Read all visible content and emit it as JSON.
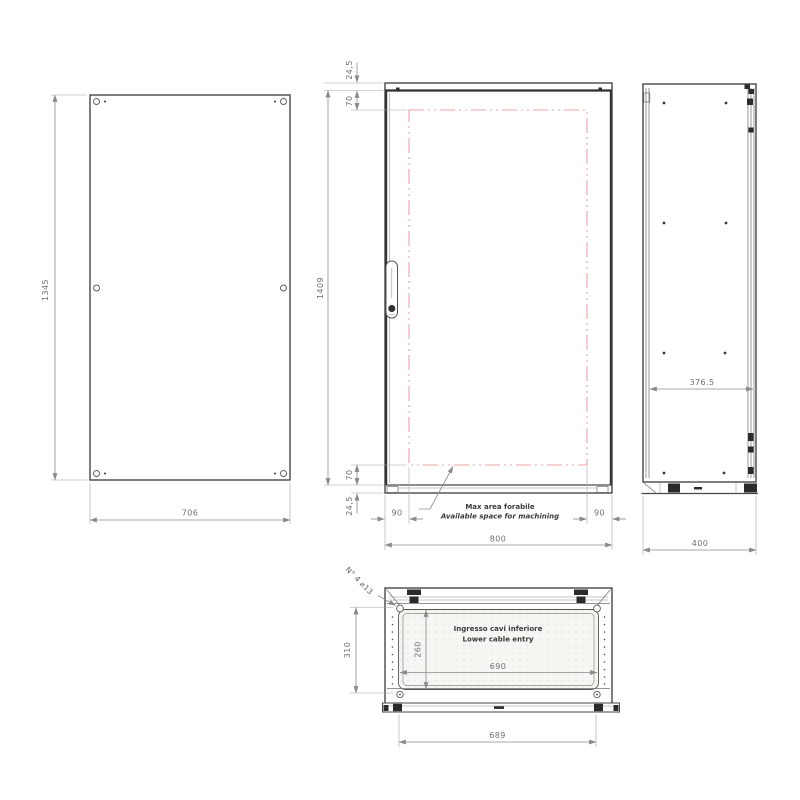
{
  "views": {
    "rear_panel": {
      "height": "1345",
      "width": "706"
    },
    "front": {
      "top_margin": "24,5",
      "top_inset": "70",
      "door_height": "1409",
      "bottom_inset": "70",
      "bottom_margin": "24,5",
      "left_offset": "90",
      "right_offset": "90",
      "width": "800",
      "note_line1": "Max area forabile",
      "note_line2": "Available space for machining"
    },
    "side": {
      "inner_depth": "376.5",
      "depth": "400"
    },
    "bottom": {
      "depth": "310",
      "opening_depth": "260",
      "opening_width": "690",
      "base_width": "689",
      "holes_label": "N° 4 ⌀13",
      "note_line1": "Ingresso cavi inferiore",
      "note_line2": "Lower cable entry"
    }
  },
  "colors": {
    "outline": "#474747",
    "dimension": "#8a8a8a",
    "machining_area_dashed": "#eca6a6"
  }
}
